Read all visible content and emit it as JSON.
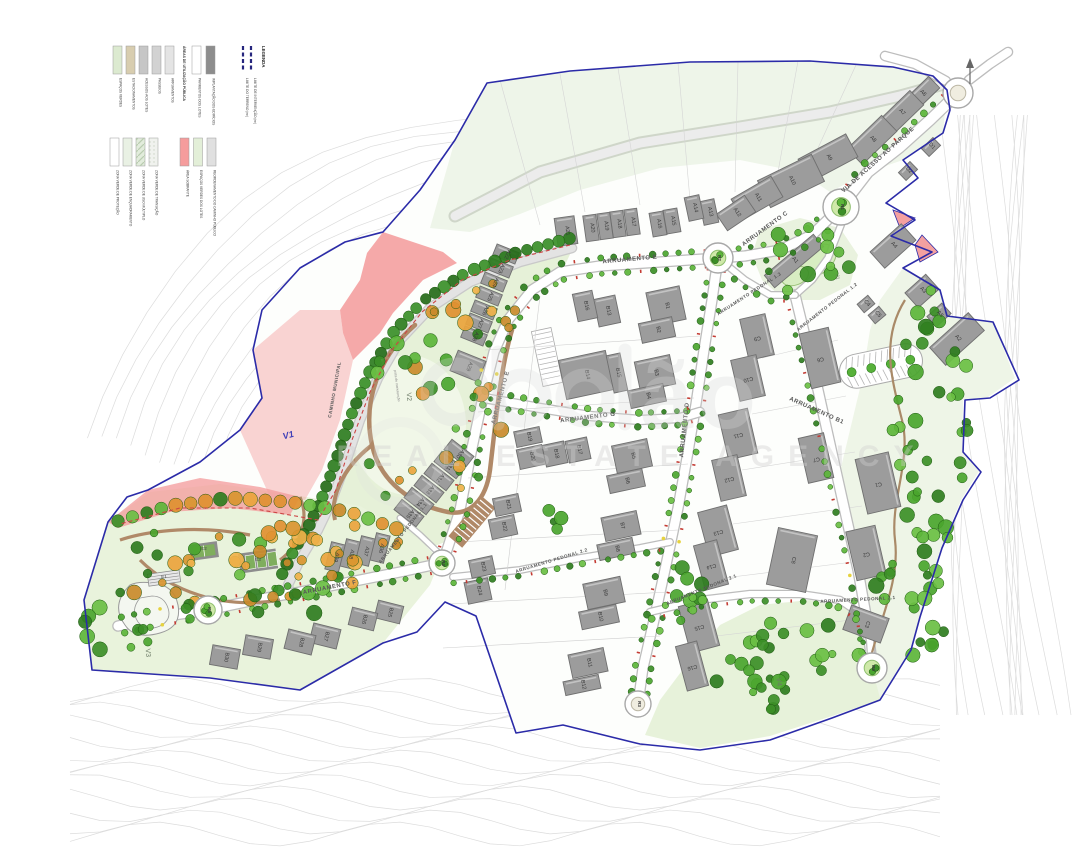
{
  "legend": {
    "title": "LEGENDA",
    "boundaries": [
      {
        "label": "LIMITE DO TERRENO (m²)",
        "color": "#26267e",
        "style": "dashed"
      },
      {
        "label": "LIMITE DE INTERVENÇÃO (m²)",
        "color": "#26267e",
        "style": "dashed"
      }
    ],
    "group1": {
      "title": "ÁREAS DE UTILIZAÇÃO PÚBLICA",
      "items": [
        {
          "label": "ESPAÇOS VERDES",
          "color": "#dcead0"
        },
        {
          "label": "ESTACIONAMENTOS",
          "color": "#d8cdaf"
        },
        {
          "label": "ACESSOS AOS LOTES",
          "color": "#c6c6c6"
        },
        {
          "label": "PASSEIOS",
          "color": "#d2d2d2"
        },
        {
          "label": "ARRUAMENTOS",
          "color": "#e4e4e4"
        }
      ]
    },
    "group2": {
      "title": "ÁREAS DOS LOTES",
      "items": [
        {
          "label": "PAVIMENTOS DOS LOTES",
          "color": "#ffffff"
        },
        {
          "label": "IMPLANTAÇÃO DOS EDIFÍCIOS",
          "color": "#8d8d8d"
        }
      ]
    },
    "group3": {
      "title": "ZONAS VERDES",
      "items": [
        {
          "label": "ZONA VERDE DE PROTEÇÃO",
          "color": "#ffffff",
          "pattern": "none"
        },
        {
          "label": "ZONA VERDE DE ENQUADRAMENTO",
          "color": "#e9f1e4",
          "pattern": "none"
        },
        {
          "label": "ZONA VERDE DE USO MÚLTIPLO",
          "color": "#e2ecdc",
          "pattern": "stripes"
        },
        {
          "label": "ZONA VERDE DE TRANSIÇÃO",
          "color": "#f0f2ee",
          "pattern": "dots"
        }
      ]
    },
    "group4": {
      "items": [
        {
          "label": "ÁREA SOBRANTE",
          "color": "#f59c9c"
        },
        {
          "label": "ESPAÇOS VERDES DOS LOTES",
          "color": "#e3efd8"
        },
        {
          "label": "REORDENAMENTO DO CAMINHO PÚBLICO",
          "color": "#e0e0e0"
        }
      ]
    }
  },
  "watermark": {
    "visible_letters": "ão",
    "tagline": "REAL ESTATE AGENCY"
  },
  "map": {
    "colors": {
      "boundary": "#2b2ba8",
      "building": "#9c9c9c",
      "building_stroke": "#6f6f6f",
      "road": "#ffffff",
      "road_edge": "#bdbdbd",
      "park": "#e7f2da",
      "pink": "#f4a0a0",
      "tree_green": "#4aa52e",
      "tree_orange": "#e49a33",
      "contour": "#dcdcdc",
      "label": "#3a3a3a"
    },
    "street_labels": [
      {
        "text": "VIA DE ACESSO AO PARQUE",
        "x": 879,
        "y": 161,
        "rot": -42,
        "size": 6
      },
      {
        "text": "ARRUAMENTO C",
        "x": 766,
        "y": 230,
        "rot": -36,
        "size": 6
      },
      {
        "text": "ARRUAMENTO E",
        "x": 630,
        "y": 261,
        "rot": -5,
        "size": 6
      },
      {
        "text": "ARRUAMENTO E",
        "x": 502,
        "y": 398,
        "rot": -75,
        "size": 6
      },
      {
        "text": "ARRUAMENTO G",
        "x": 588,
        "y": 419,
        "rot": -7,
        "size": 6
      },
      {
        "text": "ARRUAMENTO D",
        "x": 686,
        "y": 430,
        "rot": -84,
        "size": 6
      },
      {
        "text": "ARRUAMENTO B1",
        "x": 816,
        "y": 412,
        "rot": 24,
        "size": 6
      },
      {
        "text": "ARRUAMENTO F",
        "x": 330,
        "y": 589,
        "rot": -11,
        "size": 6
      },
      {
        "text": "ARRUAMENTO PEDONAL 1.1",
        "x": 404,
        "y": 534,
        "rot": -52,
        "size": 4.6
      },
      {
        "text": "ARRUAMENTO PEDONAL 1.2",
        "x": 828,
        "y": 308,
        "rot": -38,
        "size": 4.6
      },
      {
        "text": "ARRUAMENTO PEDONAL 1.3",
        "x": 750,
        "y": 295,
        "rot": -33,
        "size": 4.6
      },
      {
        "text": "ARRUAMENTO PEDONAL 2.1",
        "x": 702,
        "y": 591,
        "rot": -22,
        "size": 4.6
      },
      {
        "text": "ARRUAMENTO PEDONAL 2.1",
        "x": 858,
        "y": 601,
        "rot": -3,
        "size": 4.6
      },
      {
        "text": "ARRUAMENTO PEDONAL 2.2",
        "x": 552,
        "y": 562,
        "rot": -17,
        "size": 4.6
      },
      {
        "text": "CAMINHO MUNICIPAL",
        "x": 336,
        "y": 390,
        "rot": -80,
        "size": 4.6
      }
    ],
    "buildings": [
      [
        "A1",
        794,
        261,
        64,
        16,
        -40
      ],
      [
        "A2",
        957,
        339,
        52,
        24,
        -42
      ],
      [
        "A3",
        922,
        291,
        28,
        20,
        -42
      ],
      [
        "A4",
        893,
        246,
        42,
        22,
        -42
      ],
      [
        "A5",
        939,
        315,
        20,
        14,
        -42
      ],
      [
        "A6",
        922,
        94,
        34,
        16,
        -44
      ],
      [
        "A7",
        901,
        113,
        44,
        20,
        -44
      ],
      [
        "A8",
        872,
        140,
        48,
        22,
        -44
      ],
      [
        "A9",
        828,
        158,
        54,
        26,
        -28
      ],
      [
        "A10",
        791,
        181,
        60,
        30,
        -26
      ],
      [
        "A11",
        757,
        198,
        46,
        24,
        -30
      ],
      [
        "A12",
        736,
        213,
        34,
        20,
        -34
      ],
      [
        "A13",
        709,
        212,
        15,
        24,
        -12
      ],
      [
        "A14",
        694,
        208,
        15,
        24,
        -12
      ],
      [
        "A15",
        672,
        221,
        14,
        24,
        -10
      ],
      [
        "A16",
        658,
        224,
        14,
        24,
        -10
      ],
      [
        "A17",
        632,
        222,
        13,
        26,
        -8
      ],
      [
        "A18",
        618,
        224,
        13,
        26,
        -8
      ],
      [
        "A19",
        605,
        226,
        13,
        26,
        -8
      ],
      [
        "A20",
        591,
        228,
        13,
        26,
        -8
      ],
      [
        "A21",
        566,
        231,
        20,
        28,
        -8
      ],
      [
        "A22",
        506,
        254,
        24,
        12,
        22
      ],
      [
        "A23",
        500,
        268,
        24,
        12,
        22
      ],
      [
        "A24",
        494,
        282,
        24,
        12,
        22
      ],
      [
        "A25",
        489,
        296,
        24,
        12,
        22
      ],
      [
        "A26",
        484,
        310,
        24,
        12,
        22
      ],
      [
        "A27",
        479,
        323,
        24,
        12,
        22
      ],
      [
        "A28",
        474,
        336,
        24,
        12,
        22
      ],
      [
        "A29",
        468,
        366,
        30,
        22,
        22
      ],
      [
        "A30",
        459,
        453,
        28,
        13,
        38
      ],
      [
        "A31",
        449,
        465,
        28,
        13,
        38
      ],
      [
        "A32",
        439,
        477,
        28,
        13,
        38
      ],
      [
        "A33",
        429,
        489,
        28,
        13,
        38
      ],
      [
        "A34",
        419,
        501,
        28,
        13,
        38
      ],
      [
        "A35",
        409,
        513,
        28,
        13,
        38
      ],
      [
        "A36",
        380,
        548,
        14,
        28,
        14
      ],
      [
        "A37",
        365,
        551,
        14,
        28,
        14
      ],
      [
        "A38",
        350,
        554,
        14,
        28,
        14
      ],
      [
        "A39",
        335,
        557,
        14,
        28,
        14
      ],
      [
        "B1",
        666,
        306,
        34,
        34,
        -12
      ],
      [
        "B2",
        657,
        330,
        34,
        20,
        -12
      ],
      [
        "B3",
        655,
        373,
        36,
        30,
        -12
      ],
      [
        "B4",
        647,
        396,
        36,
        18,
        -12
      ],
      [
        "B5",
        632,
        456,
        36,
        28,
        -12
      ],
      [
        "B6",
        626,
        481,
        36,
        18,
        -12
      ],
      [
        "B7",
        621,
        526,
        36,
        24,
        -12
      ],
      [
        "B8",
        616,
        549,
        36,
        16,
        -12
      ],
      [
        "B9",
        604,
        593,
        38,
        26,
        -12
      ],
      [
        "B10",
        599,
        617,
        38,
        18,
        -12
      ],
      [
        "B11",
        588,
        663,
        36,
        24,
        -12
      ],
      [
        "B12",
        582,
        685,
        36,
        14,
        -12
      ],
      [
        "B13",
        607,
        311,
        22,
        28,
        -12
      ],
      [
        "B14",
        586,
        375,
        48,
        40,
        -12
      ],
      [
        "B15",
        617,
        373,
        14,
        38,
        -12
      ],
      [
        "B16",
        585,
        306,
        20,
        28,
        -12
      ],
      [
        "B17",
        578,
        450,
        22,
        22,
        -12
      ],
      [
        "B18",
        555,
        454,
        22,
        22,
        -12
      ],
      [
        "B19",
        528,
        437,
        26,
        16,
        -12
      ],
      [
        "B20",
        531,
        457,
        26,
        20,
        -12
      ],
      [
        "B21",
        507,
        505,
        26,
        18,
        -12
      ],
      [
        "B22",
        503,
        527,
        26,
        20,
        -12
      ],
      [
        "B23",
        482,
        567,
        24,
        18,
        -12
      ],
      [
        "B24",
        478,
        591,
        24,
        22,
        -12
      ],
      [
        "B25",
        389,
        612,
        26,
        18,
        14
      ],
      [
        "B26",
        363,
        619,
        26,
        18,
        14
      ],
      [
        "B27",
        325,
        636,
        28,
        20,
        14
      ],
      [
        "B28",
        300,
        642,
        28,
        20,
        14
      ],
      [
        "B29",
        258,
        647,
        28,
        20,
        10
      ],
      [
        "B30",
        225,
        657,
        28,
        20,
        10
      ],
      [
        "C1",
        878,
        483,
        56,
        34,
        77
      ],
      [
        "C2",
        866,
        553,
        50,
        30,
        77
      ],
      [
        "C3",
        866,
        624,
        40,
        26,
        20
      ],
      [
        "C4",
        866,
        304,
        14,
        11,
        -40
      ],
      [
        "C5",
        877,
        315,
        14,
        11,
        -40
      ],
      [
        "C6",
        820,
        358,
        56,
        30,
        77
      ],
      [
        "C7",
        816,
        458,
        46,
        26,
        77
      ],
      [
        "C8",
        792,
        560,
        40,
        58,
        12
      ],
      [
        "C9",
        757,
        337,
        42,
        26,
        77
      ],
      [
        "C10",
        748,
        378,
        42,
        26,
        77
      ],
      [
        "C11",
        738,
        434,
        46,
        30,
        77
      ],
      [
        "C12",
        729,
        478,
        42,
        26,
        77
      ],
      [
        "C13",
        718,
        531,
        46,
        30,
        75
      ],
      [
        "C14",
        711,
        565,
        46,
        24,
        75
      ],
      [
        "C15",
        699,
        626,
        48,
        30,
        75
      ],
      [
        "C16",
        692,
        666,
        46,
        22,
        75
      ],
      [
        "D1",
        931,
        147,
        16,
        11,
        -44
      ],
      [
        "D2",
        908,
        171,
        16,
        11,
        -44
      ]
    ],
    "roundabouts": [
      {
        "id": "R1",
        "x": 841,
        "y": 207,
        "r": 18,
        "green": true
      },
      {
        "id": "R2",
        "x": 718,
        "y": 258,
        "r": 15,
        "green": true
      },
      {
        "id": "R3",
        "x": 638,
        "y": 704,
        "r": 13,
        "green": false
      },
      {
        "id": "R4",
        "x": 442,
        "y": 563,
        "r": 13,
        "green": true
      },
      {
        "id": "R5",
        "x": 208,
        "y": 610,
        "r": 14,
        "green": true
      },
      {
        "id": "R6",
        "x": 872,
        "y": 668,
        "r": 15,
        "green": true
      },
      {
        "id": "",
        "x": 958,
        "y": 93,
        "r": 15,
        "green": false
      }
    ],
    "area_labels": [
      {
        "id": "V1",
        "x": 289,
        "y": 438,
        "rot": -15,
        "size": 9,
        "color": "#4040b8",
        "script": true
      },
      {
        "id": "V2",
        "x": 407,
        "y": 397,
        "rot": 85,
        "size": 7,
        "color": "#6b7a66"
      },
      {
        "id": "V3",
        "x": 146,
        "y": 653,
        "rot": 85,
        "size": 7,
        "color": "#6b7a66"
      },
      {
        "id": "V4",
        "x": 777,
        "y": 682,
        "rot": 85,
        "size": 7,
        "color": "#6b7a66"
      },
      {
        "id": "J1",
        "x": 836,
        "y": 277,
        "rot": 85,
        "size": 5,
        "color": "#6b7a66"
      },
      {
        "id": "E1",
        "x": 164,
        "y": 578,
        "rot": 0,
        "size": 4.5,
        "color": "#444444"
      },
      {
        "id": "E2",
        "x": 204,
        "y": 550,
        "rot": 0,
        "size": 4.5,
        "color": "#444444"
      },
      {
        "id": "E3",
        "x": 258,
        "y": 561,
        "rot": 0,
        "size": 4.5,
        "color": "#444444"
      }
    ],
    "captions": [
      {
        "text": "pista de manutenção",
        "x": 396,
        "y": 386,
        "rot": 83,
        "size": 3.4,
        "color": "#888888"
      }
    ]
  }
}
